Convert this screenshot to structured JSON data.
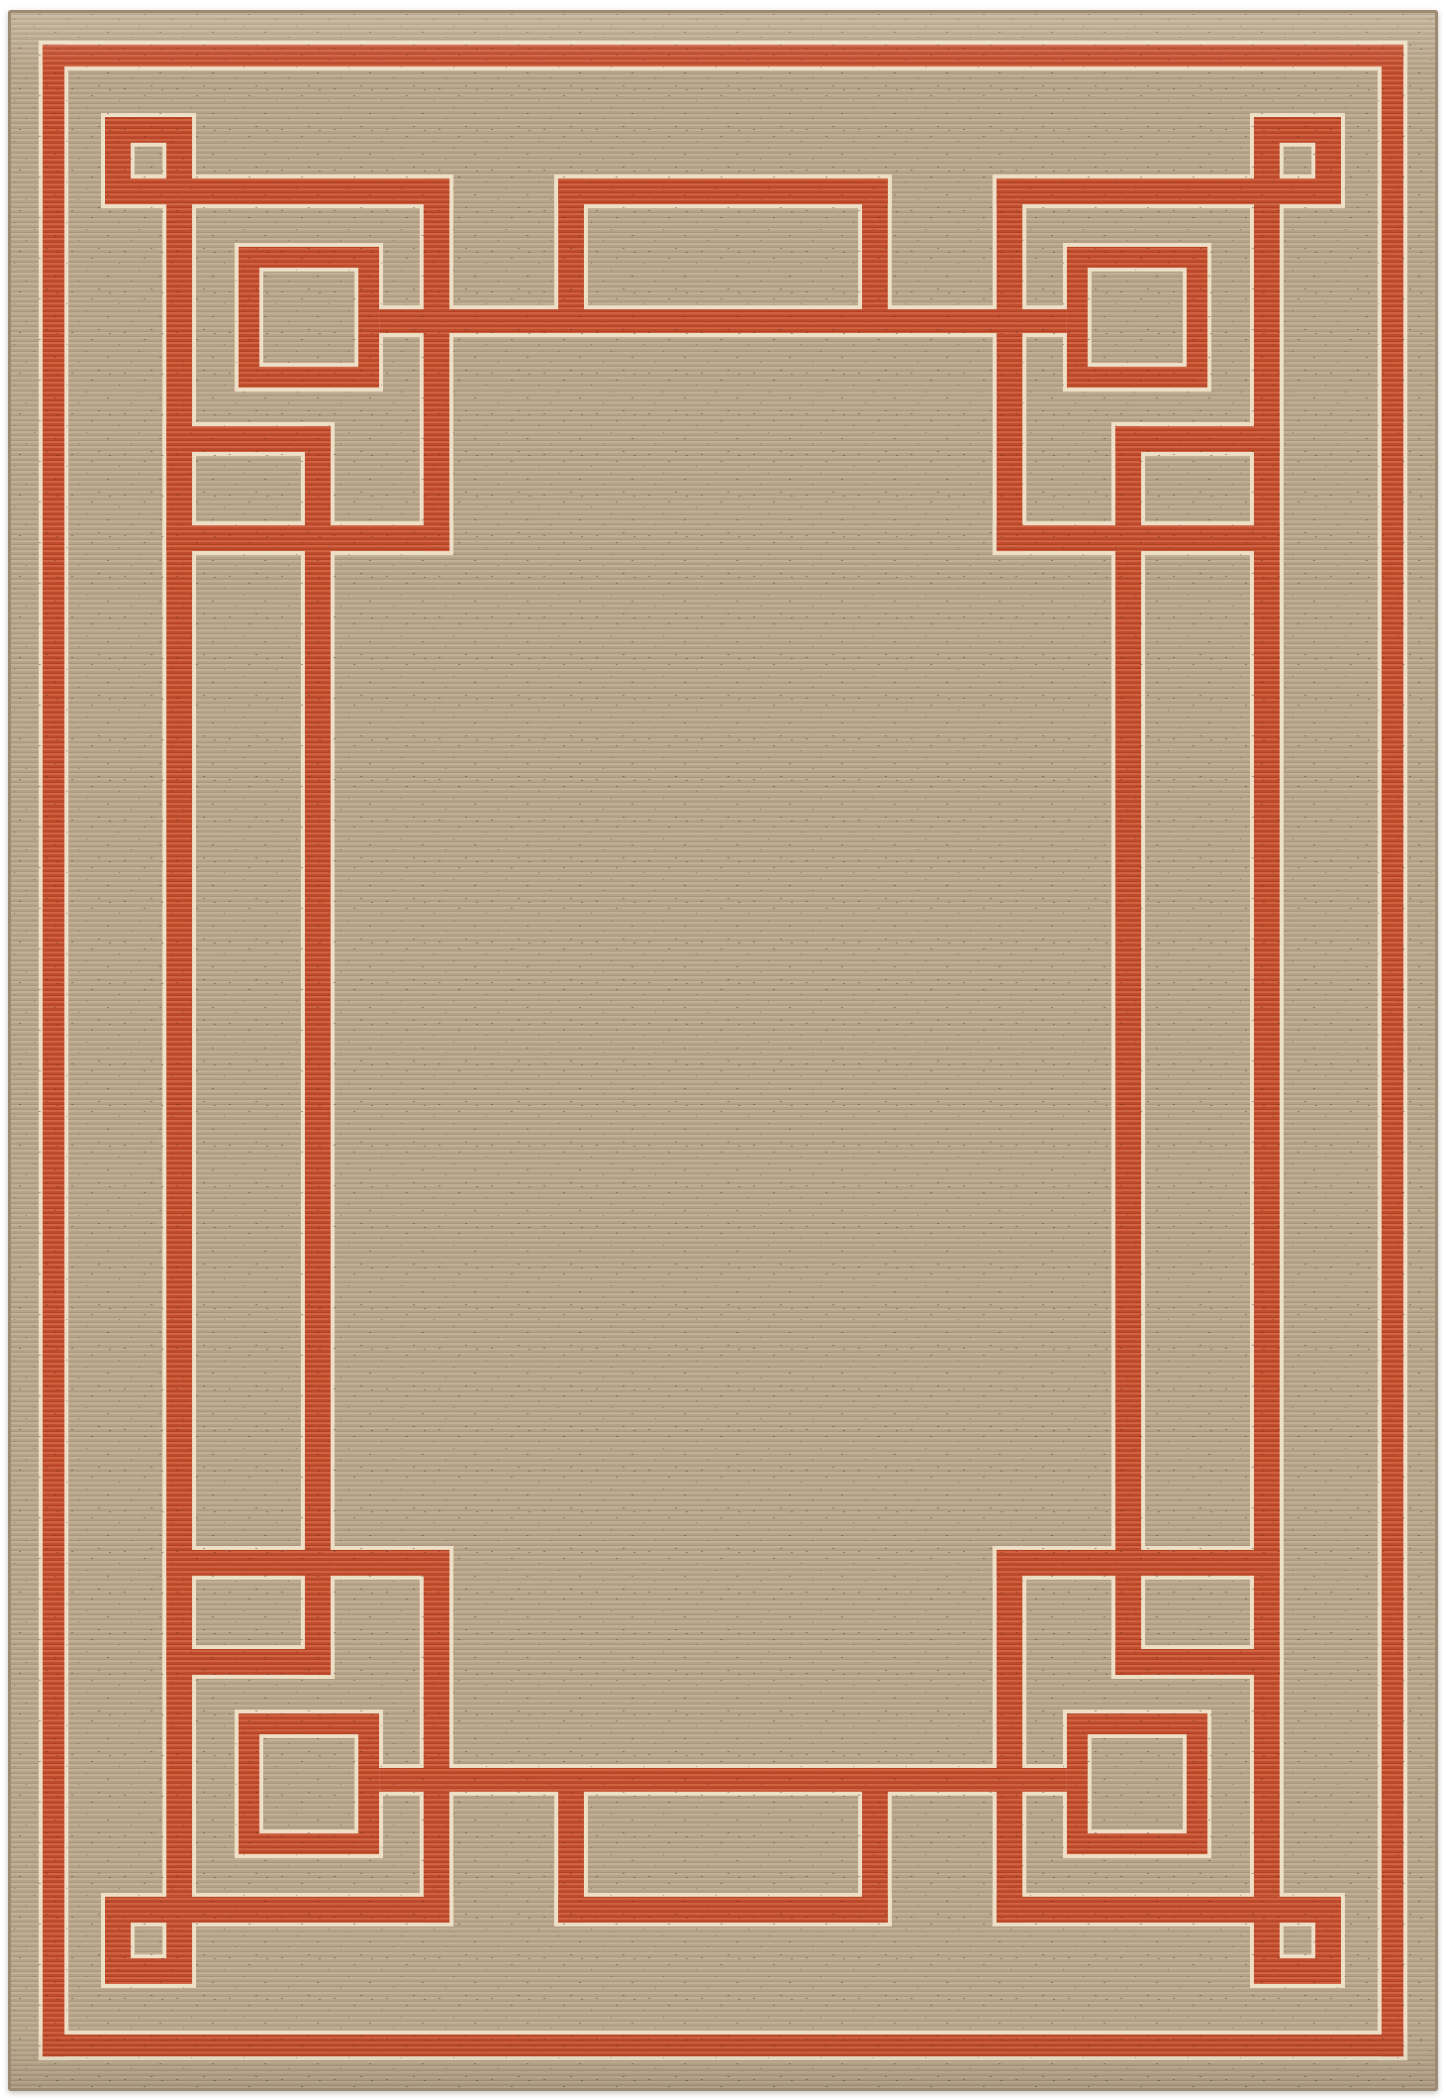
{
  "image": {
    "alt": "Product photo of a rectangular flatweave area rug: natural tan woven ground with a rust-red Art-Deco Greek-key fret border, thin cream outlines around every red line, nested squares in each corner and a plain open tan field in the center"
  },
  "palette": {
    "photo_background": "#ffffff",
    "tan_base": "#b5a389",
    "tan_rib_light": "#c3b196",
    "tan_rib_dark": "#a8957c",
    "speckle": "#6f5d49",
    "red_base": "#bf4b2e",
    "red_rib_light": "#d06443",
    "red_rib_dark": "#b2401f",
    "cream_outline": "#eee0c7",
    "edge_binding": "#9c8b72",
    "shadow": "rgba(90,75,55,0.35)"
  },
  "rug": {
    "canvas_width": 1445,
    "canvas_height": 2100,
    "outline_pad": 4,
    "weave_pitch": 5,
    "lines": [
      [
        35,
        35,
        1375,
        22
      ],
      [
        35,
        2043,
        1375,
        22
      ],
      [
        35,
        35,
        22,
        2030
      ],
      [
        1388,
        35,
        22,
        2030
      ],
      [
        160,
        170,
        286,
        26
      ],
      [
        999,
        170,
        286,
        26
      ],
      [
        160,
        1904,
        286,
        26
      ],
      [
        999,
        1904,
        286,
        26
      ],
      [
        160,
        196,
        26,
        1708
      ],
      [
        1259,
        196,
        26,
        1708
      ],
      [
        420,
        170,
        26,
        376
      ],
      [
        999,
        170,
        26,
        376
      ],
      [
        420,
        1554,
        26,
        376
      ],
      [
        999,
        1554,
        26,
        376
      ],
      [
        160,
        520,
        286,
        26
      ],
      [
        999,
        520,
        286,
        26
      ],
      [
        160,
        1554,
        286,
        26
      ],
      [
        999,
        1554,
        286,
        26
      ],
      [
        160,
        420,
        166,
        26
      ],
      [
        1119,
        420,
        166,
        26
      ],
      [
        160,
        1654,
        166,
        26
      ],
      [
        1119,
        1654,
        166,
        26
      ],
      [
        300,
        420,
        26,
        1260
      ],
      [
        1119,
        420,
        26,
        1260
      ],
      [
        375,
        302,
        695,
        24
      ],
      [
        375,
        1774,
        695,
        24
      ],
      [
        556,
        170,
        333,
        26
      ],
      [
        556,
        1904,
        333,
        26
      ],
      [
        556,
        170,
        26,
        156
      ],
      [
        863,
        170,
        26,
        156
      ],
      [
        556,
        1774,
        26,
        156
      ],
      [
        863,
        1774,
        26,
        156
      ]
    ],
    "rings": [
      {
        "o": [
          98,
          108,
          88,
          88
        ],
        "hole": [
          124,
          134,
          36,
          36
        ]
      },
      {
        "o": [
          1259,
          108,
          88,
          88
        ],
        "hole": [
          1285,
          134,
          36,
          36
        ]
      },
      {
        "o": [
          98,
          1904,
          88,
          88
        ],
        "hole": [
          124,
          1930,
          36,
          36
        ]
      },
      {
        "o": [
          1259,
          1904,
          88,
          88
        ],
        "hole": [
          1285,
          1930,
          36,
          36
        ]
      },
      {
        "o": [
          233,
          239,
          142,
          142
        ],
        "hole": [
          254,
          260,
          100,
          100
        ]
      },
      {
        "o": [
          1070,
          239,
          142,
          142
        ],
        "hole": [
          1091,
          260,
          100,
          100
        ]
      },
      {
        "o": [
          233,
          1719,
          142,
          142
        ],
        "hole": [
          254,
          1740,
          100,
          100
        ]
      },
      {
        "o": [
          1070,
          1719,
          142,
          142
        ],
        "hole": [
          1091,
          1740,
          100,
          100
        ]
      }
    ]
  }
}
